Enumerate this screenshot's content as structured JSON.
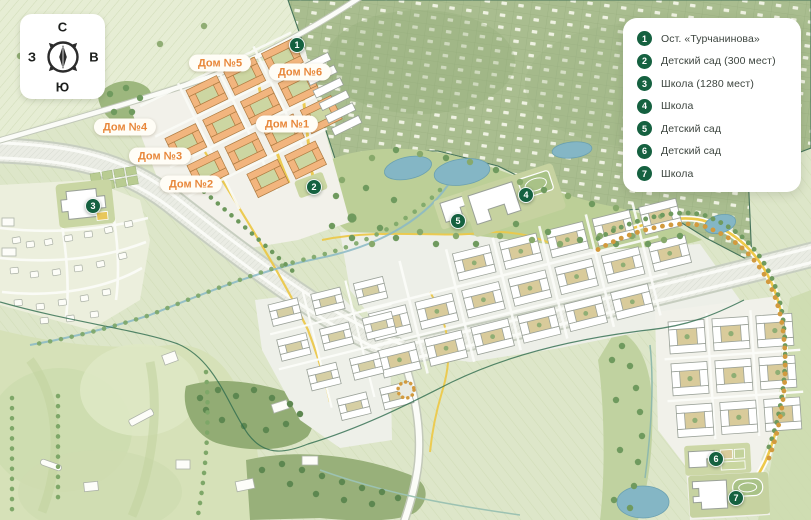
{
  "compass": {
    "north": "С",
    "west": "З",
    "east": "В",
    "south": "Ю"
  },
  "legend": {
    "items": [
      {
        "num": "1",
        "label": "Ост. «Турчанинова»"
      },
      {
        "num": "2",
        "label": "Детский сад (300 мест)"
      },
      {
        "num": "3",
        "label": "Школа (1280 мест)"
      },
      {
        "num": "4",
        "label": "Школа"
      },
      {
        "num": "5",
        "label": "Детский сад"
      },
      {
        "num": "6",
        "label": "Детский сад"
      },
      {
        "num": "7",
        "label": "Школа"
      }
    ]
  },
  "house_labels": {
    "items": [
      {
        "label": "Дом №5"
      },
      {
        "label": "Дом №6"
      },
      {
        "label": "Дом №4"
      },
      {
        "label": "Дом №1"
      },
      {
        "label": "Дом №3"
      },
      {
        "label": "Дом №2"
      }
    ]
  },
  "markers": {
    "items": [
      {
        "num": "1"
      },
      {
        "num": "2"
      },
      {
        "num": "3"
      },
      {
        "num": "4"
      },
      {
        "num": "5"
      },
      {
        "num": "6"
      },
      {
        "num": "7"
      }
    ]
  },
  "colors": {
    "marker_green": "#156140",
    "label_orange": "#e8873a",
    "water_blue": "#84b6c5",
    "path_yellow": "#ecc94b",
    "legend_text": "#3c443e"
  }
}
